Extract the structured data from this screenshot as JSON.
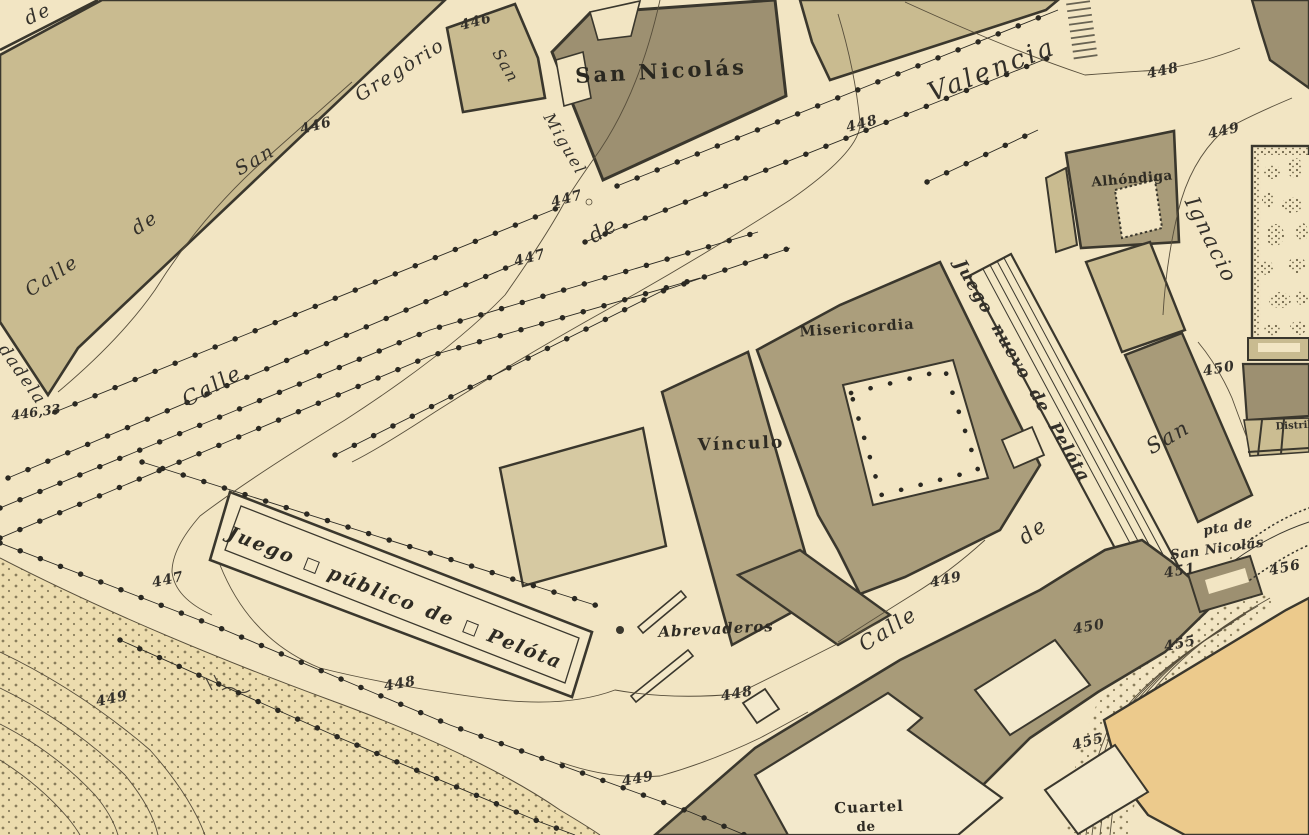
{
  "map_type": "historical-town-plan",
  "colors": {
    "paper": "#f2e5c3",
    "block_tan": "#c9bb90",
    "block_tan_light": "#d6c9a2",
    "building_olive": "#a89b79",
    "building_dark": "#9d9071",
    "bastion_orange": "#ecca8c",
    "glacis": "#ecdcae",
    "ink": "#3a372d",
    "contour": "#574e3b",
    "label_ink": "#33302a"
  },
  "labels": {
    "corner_de": "de",
    "sg_calle": "Calle",
    "sg_de": "de",
    "sg_san": "San",
    "sg_gregorio": "Gregòrio",
    "elev_446_sg": "446",
    "elev_446_top": "446",
    "elev_446_33": "446,33",
    "sm_san": "San",
    "sm_miguel": "Miguel",
    "san_nicolas": "San  Nicolás",
    "pv_calle": "Calle",
    "pv_de": "de",
    "pv_valencia": "Valencia",
    "elev_447_top": "447",
    "elev_447_mid": "447",
    "elev_447_left": "447",
    "elev_448_blvd": "448",
    "elev_448_plaza": "448",
    "elev_448_jp": "448",
    "elev_448_abrev": "448",
    "elev_449_plaza": "449",
    "elev_449_calle": "449",
    "elev_449_bottom": "449",
    "elev_449_glacis": "449",
    "elev_450_ignacio": "450",
    "elev_450_slope": "450",
    "elev_451": "451",
    "elev_455_a": "455",
    "elev_455_b": "455",
    "elev_456": "456",
    "ciudadela_partial": "dadela",
    "alhondiga": "Alhóndiga",
    "csi_ignacio": "Ignacio",
    "csi_san": "San",
    "csi_de": "de",
    "csi_calle": "Calle",
    "misericordia": "Misericordia",
    "vinculo": "Vínculo",
    "juego_nuevo": "Juego nuevo de Pelóta",
    "jp_w1": "Juego",
    "jp_w2": "público",
    "jp_w3": "de",
    "jp_w4": "Pelóta",
    "abrevaderos": "Abrevaderos",
    "cuartel": "Cuartel",
    "cuartel_de": "de",
    "pta_line1": "pta de",
    "pta_line2": "San Nicolás",
    "distrib_partial": "Distrib"
  }
}
